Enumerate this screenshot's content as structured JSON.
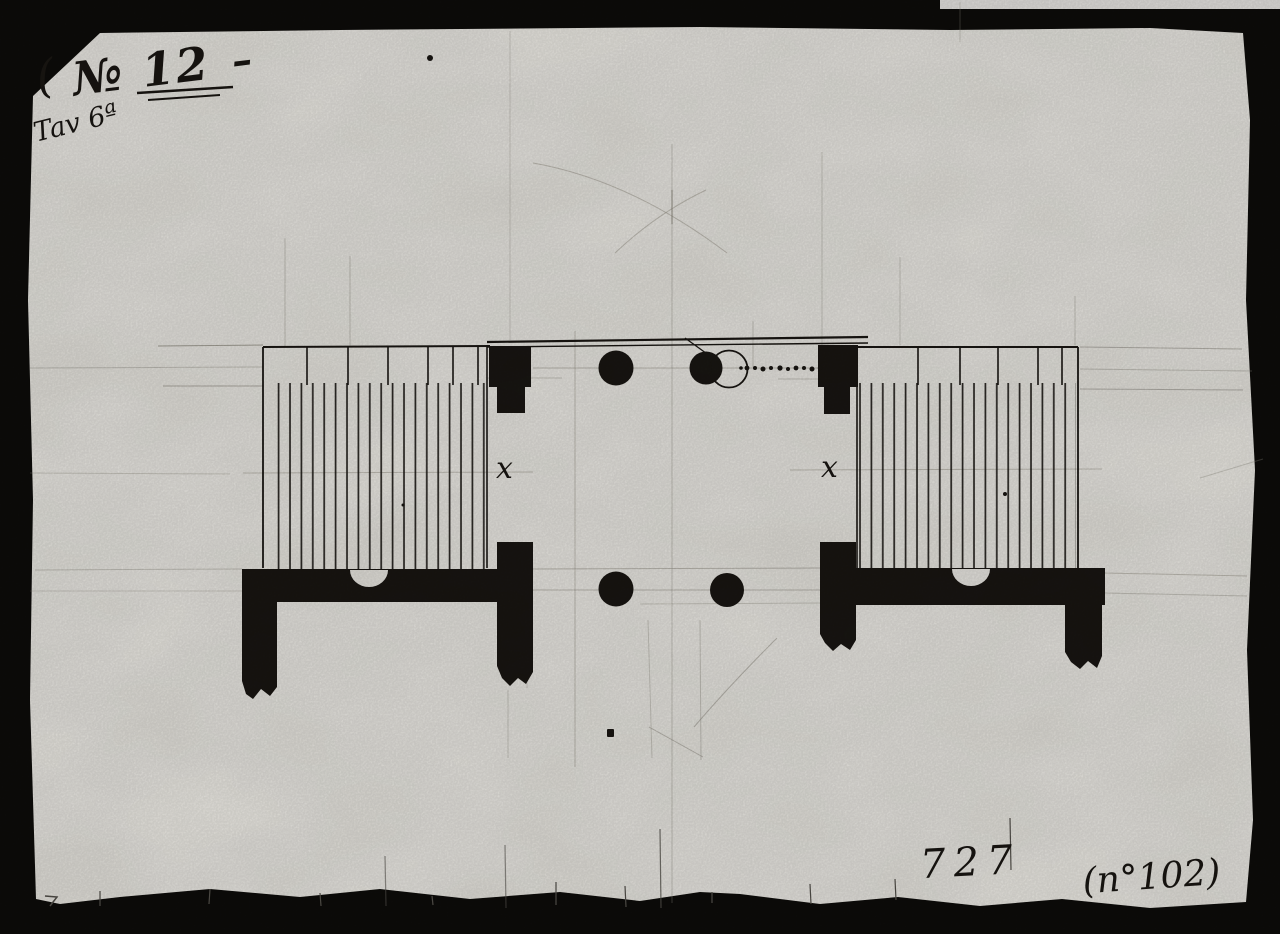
{
  "image": {
    "description": "Scanned archival hand-drawn architectural plan (ink and pencil on aged paper) inside a black photographic mount",
    "colors": {
      "mount_black": "#0d0c0a",
      "paper": "#f0eee8",
      "ink": "#1a1713",
      "pencil": "#8d897f"
    },
    "annotations": {
      "corner_paren": "(",
      "drawing_number": "№ 12",
      "drawing_number_dash": "–",
      "plate_label": "Tav 6ª",
      "mark_left_pier": "x",
      "mark_right_pier": "x",
      "folio_number": "727",
      "inventory_number": "(n°102)"
    }
  }
}
